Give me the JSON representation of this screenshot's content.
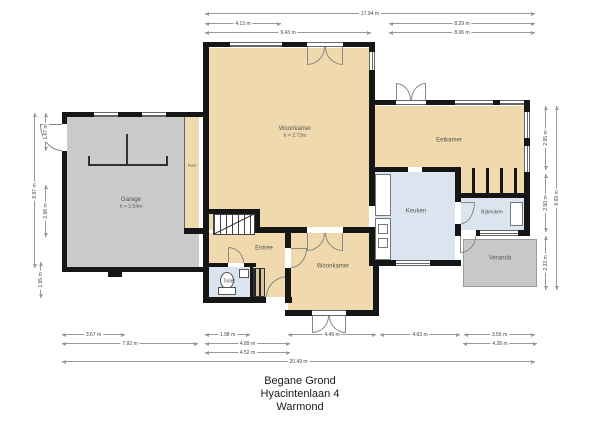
{
  "plan": {
    "title_lines": [
      "Begane Grond",
      "Hyacintenlaan 4",
      "Warmond"
    ]
  },
  "rooms": {
    "garage": {
      "name": "Garage",
      "height": "h = 2.54m"
    },
    "kast": {
      "name": "Kast"
    },
    "woonkamer": {
      "name": "Woonkamer",
      "height": "h = 2.73m"
    },
    "eetkamer": {
      "name": "Eetkamer"
    },
    "keuken": {
      "name": "Keuken"
    },
    "bijkeuken": {
      "name": "Bijkeuken"
    },
    "veranda": {
      "name": "Veranda"
    },
    "woonkamer2": {
      "name": "Woonkamer"
    },
    "entree": {
      "name": "Entree"
    },
    "toilet": {
      "name": "Toilet"
    }
  },
  "dimensions": {
    "top": {
      "total": "17.94 m",
      "left_inner": "4.13 m",
      "left_outer": "9.43 m",
      "right_inner": "8.29 m",
      "right_outer": "8.06 m"
    },
    "bottom": {
      "b1a": "3.67 m",
      "b1b": "1.98 m",
      "b1c": "4.49 m",
      "b1d": "4.63 m",
      "b1e": "3.55 m",
      "b2a": "7.92 m",
      "b2b": "4.89 m",
      "b2c": "4.28 m",
      "b3": "4.52 m",
      "total": "20.49 m"
    },
    "left": {
      "outer": "8.97 m",
      "top": "1.67 m",
      "mid": "2.98 m",
      "bottom": "1.95 m"
    },
    "right": {
      "outer": "8.69 m",
      "top": "2.95 m",
      "mid": "2.50 m",
      "bottom": "2.33 m"
    }
  },
  "colors": {
    "wall": "#161616",
    "floor_living": "#f0d9ac",
    "floor_wet": "#dbe5f0",
    "floor_garage": "#cacaca",
    "floor_veranda": "#c8c8c8"
  }
}
